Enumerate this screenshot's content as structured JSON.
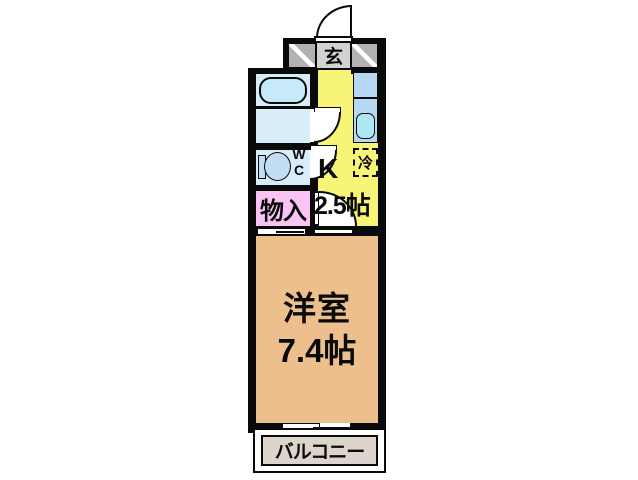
{
  "rooms": {
    "entrance": {
      "label": "玄"
    },
    "kitchen": {
      "label": "K",
      "size": "2.5帖"
    },
    "fridge": {
      "label": "冷"
    },
    "wc": {
      "label_line1": "W",
      "label_line2": "C"
    },
    "closet": {
      "label": "物入"
    },
    "main_room": {
      "name": "洋室",
      "size": "7.4帖"
    },
    "balcony": {
      "label": "バルコニー"
    }
  },
  "colors": {
    "wall": "#0a0a0a",
    "entrance_floor": "#d2d2d2",
    "entrance_hatch_wall": "#b2b2b2",
    "kitchen_floor": "#f8f478",
    "bathroom_floor": "#d8edfa",
    "bathtub": "#c6eaf8",
    "kitchen_counter": "#b7d7f2",
    "kitchen_sink": "#aee6f2",
    "toilet": "#c2ddf4",
    "closet_floor": "#f9c4f3",
    "main_room_floor": "#edbf8c",
    "balcony_floor": "#ddd5cc",
    "background": "#ffffff"
  }
}
